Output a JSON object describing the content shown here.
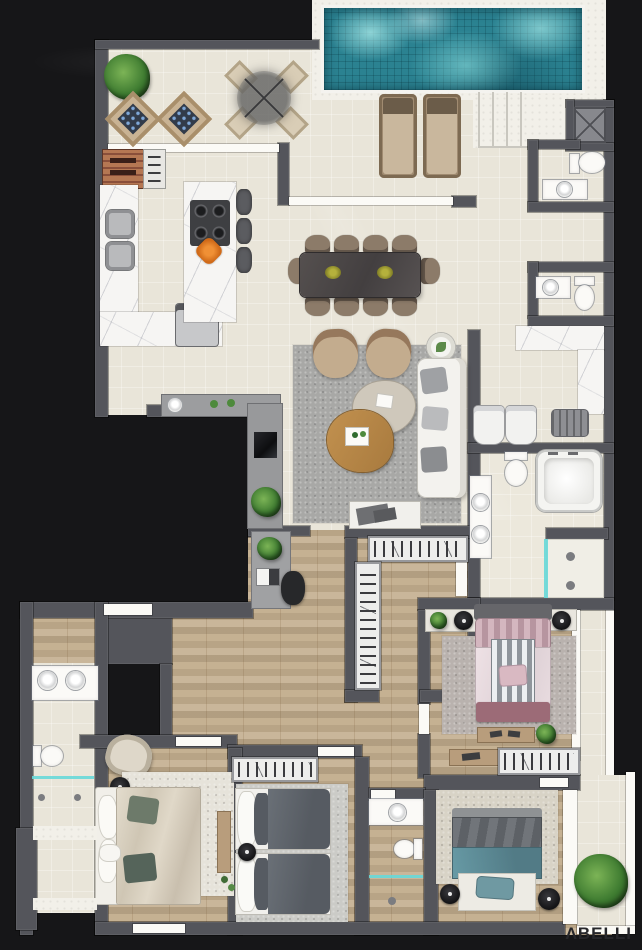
{
  "brand": {
    "logo_text": "ΛBELLI"
  },
  "palette": {
    "bg": "#161618",
    "wall": "#54555b",
    "cream": "#e9e5d9",
    "deck": "#f2f0e9",
    "wood": "#c3ae8e",
    "marble": "#f6f5f3",
    "pool": "#2b8291",
    "glass": "#67d8d8",
    "rug_living": "#a8a8a6",
    "rug_bedroom1": "#e6e3da",
    "rug_bedroom2": "#cbcbc7",
    "rug_bedroom3": "#d8d3c6",
    "rug_master": "#b9b2ae",
    "bed_teal": "#5e8994",
    "bed_gray": "#60656c",
    "bed_mauve": "#9c6b77",
    "sofa_white": "#f3f2ee",
    "tan_chair": "#c3ac8e",
    "logo": "#26262a"
  },
  "plan": {
    "type": "residential-floor-plan-top-view",
    "areas": [
      "pool",
      "pool-deck",
      "terrace",
      "barbecue",
      "kitchen",
      "kitchen-island",
      "dining-area",
      "living-area",
      "elevator",
      "lavatory-1",
      "lavatory-2",
      "hall",
      "laundry",
      "master-bathroom",
      "walk-in-closet",
      "home-office-nook",
      "master-bedroom",
      "bedroom-1",
      "bedroom-2",
      "bedroom-3",
      "suite-bathroom",
      "social-bathroom",
      "balcony"
    ]
  }
}
